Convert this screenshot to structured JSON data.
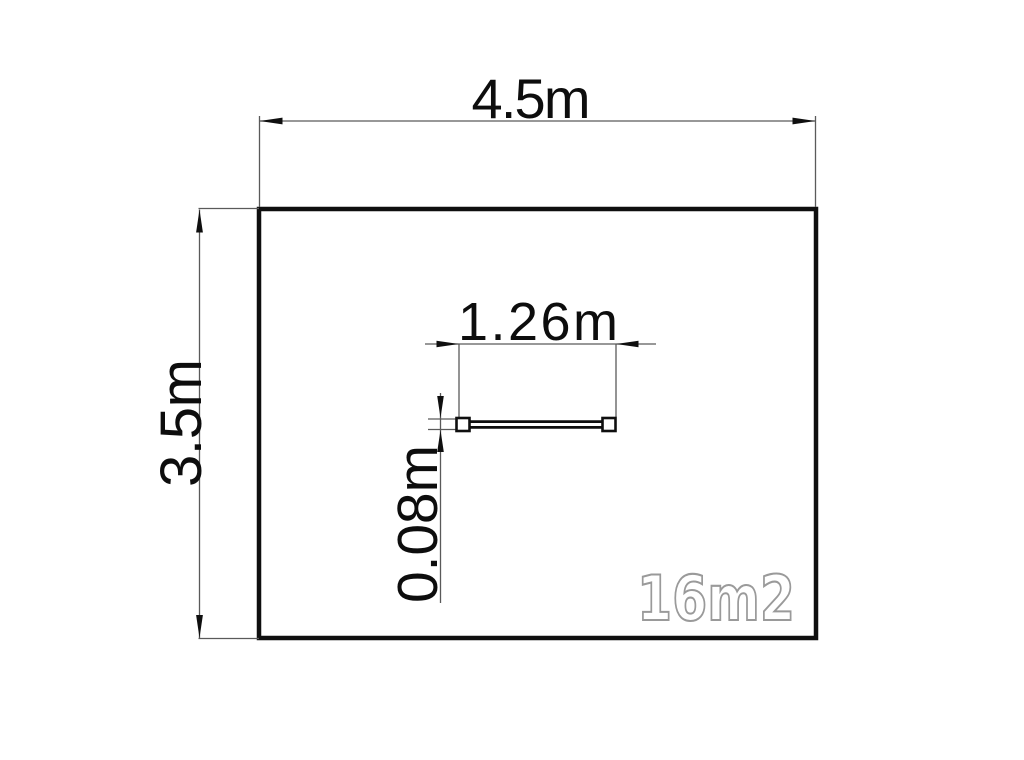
{
  "floor_plan": {
    "labels": {
      "room_width": "4.5m",
      "room_height": "3.5m",
      "window_width": "1.26m",
      "window_thickness": "0.08m",
      "area": "16m2"
    },
    "colors": {
      "background": "#ffffff",
      "wall_line": "#0f0f0f",
      "dimension_line": "#5a5a5a",
      "arrowhead": "#0f0f0f",
      "area_label_outline": "#9a9a9a",
      "area_label_fill": "#ffffff"
    }
  }
}
